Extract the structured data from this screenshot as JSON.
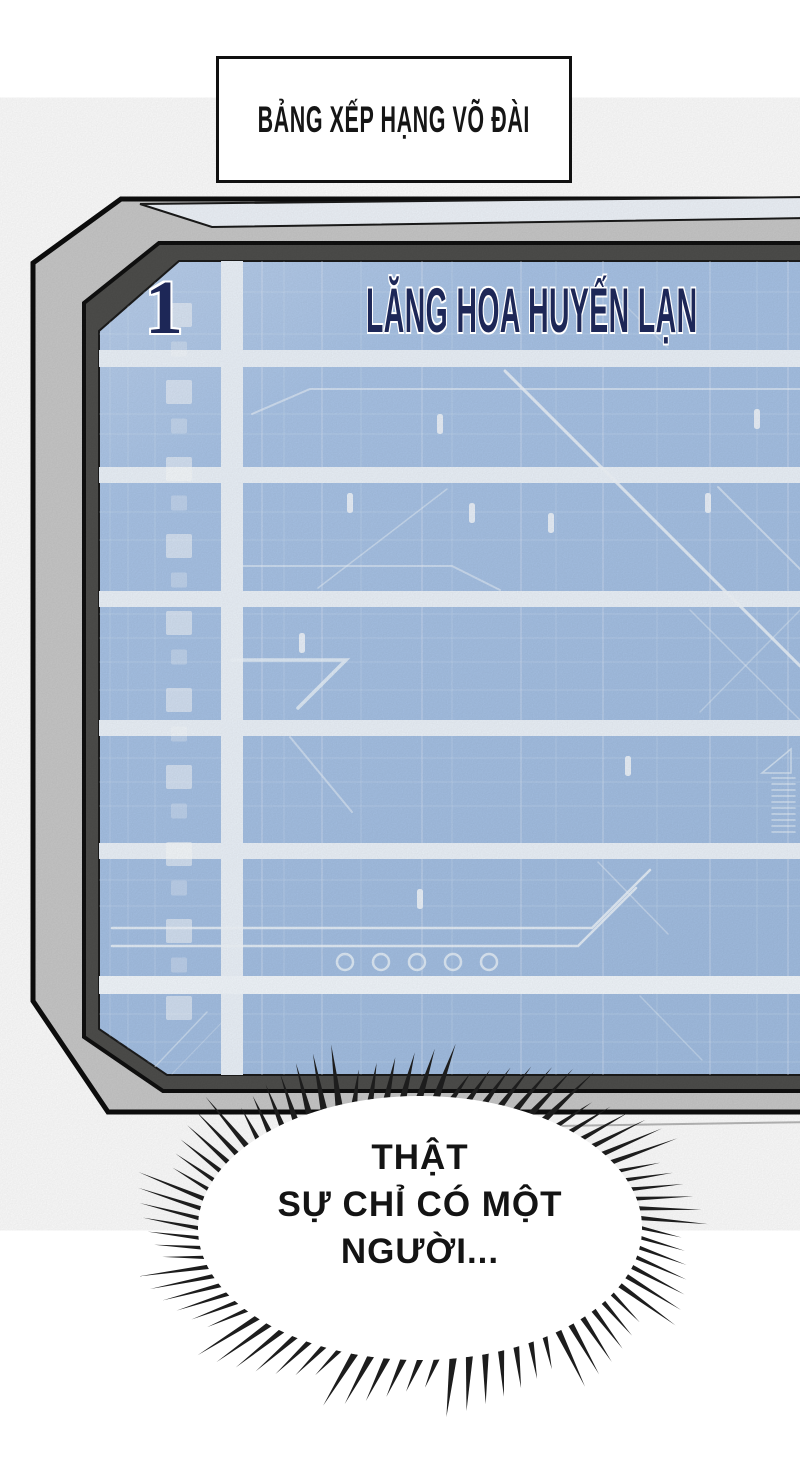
{
  "title_box": {
    "label": "BẢNG XẾP HẠNG VÕ ĐÀI"
  },
  "leaderboard": {
    "rows": [
      {
        "rank": "1",
        "player": "LĂNG HOA HUYẾN LẠN"
      }
    ],
    "visible_empty_rows": 6
  },
  "speech_bubble": {
    "lines": [
      "THẬT",
      "SỰ CHỈ CÓ MỘT",
      "NGƯỜI..."
    ]
  },
  "colors": {
    "screen_blue": "#a7c2e5",
    "screen_band": "#edf4fb",
    "frame_gray": "#c9c9c9",
    "frame_dark": "#4e4e4c",
    "rank_text": "#1d2757",
    "outline_black": "#101010"
  }
}
